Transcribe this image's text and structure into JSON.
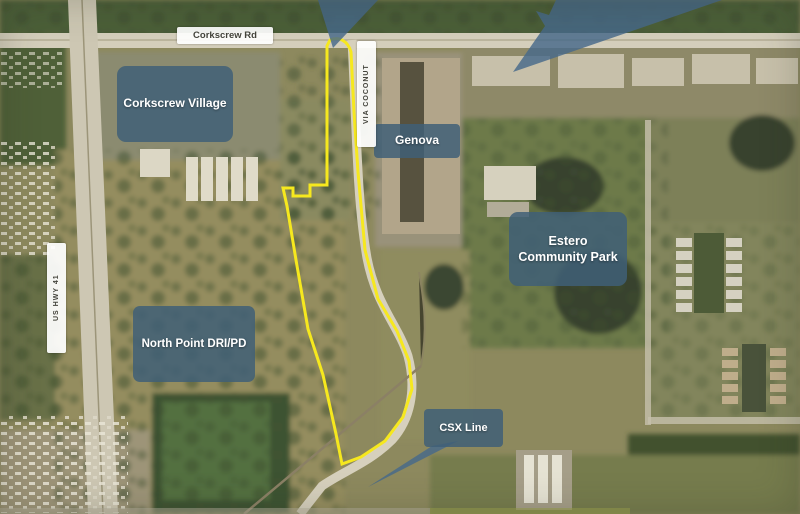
{
  "map": {
    "title": "Aerial site map with outlined parcel boundary",
    "labels": {
      "corkscrew_rd": "Corkscrew Rd",
      "via_coconut": "VIA COCONUT",
      "us_hwy_41": "US HWY 41",
      "corkscrew_village": "Corkscrew Village",
      "genova": "Genova",
      "estero_park": "Estero Community Park",
      "north_point": "North Point DRI/PD",
      "csx_line": "CSX Line"
    },
    "colors": {
      "area_label_bg": "#3f5f77",
      "area_label_text": "#ffffff",
      "road_label_bg": "#ffffff",
      "road_label_text": "#44443c",
      "site_boundary": "#f6e81e",
      "callout_arrow": "#47698a"
    }
  }
}
